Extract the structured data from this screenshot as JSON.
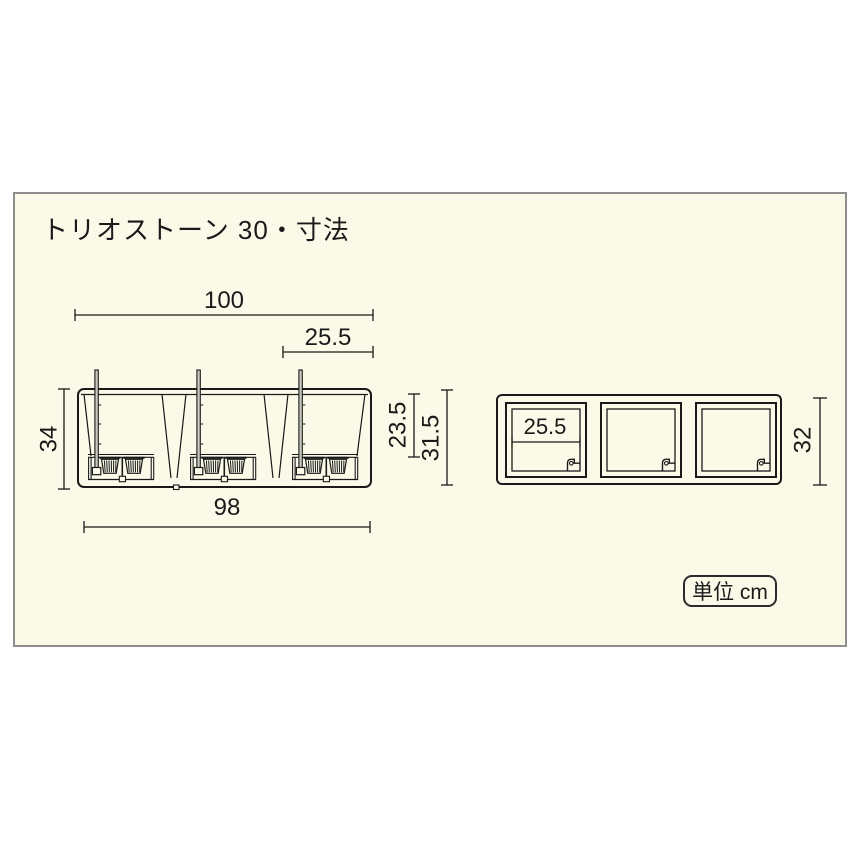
{
  "title": "トリオストーン 30・寸法",
  "unit_box": {
    "label": "単位 cm"
  },
  "colors": {
    "page_background": "#FFFFFF",
    "panel_background": "#FBFAE8",
    "panel_border": "#8E8E8E",
    "line_color": "#1A1A1A"
  },
  "front_view": {
    "description": "front elevation of 3-pot planter",
    "dims": {
      "overall_width": "100",
      "pot_width": "25.5",
      "overall_height": "34",
      "pot_depth": "23.5",
      "body_height": "31.5",
      "base_width": "98"
    }
  },
  "top_view": {
    "description": "plan view with three square openings",
    "dims": {
      "opening_width": "25.5",
      "overall_depth": "32"
    }
  }
}
